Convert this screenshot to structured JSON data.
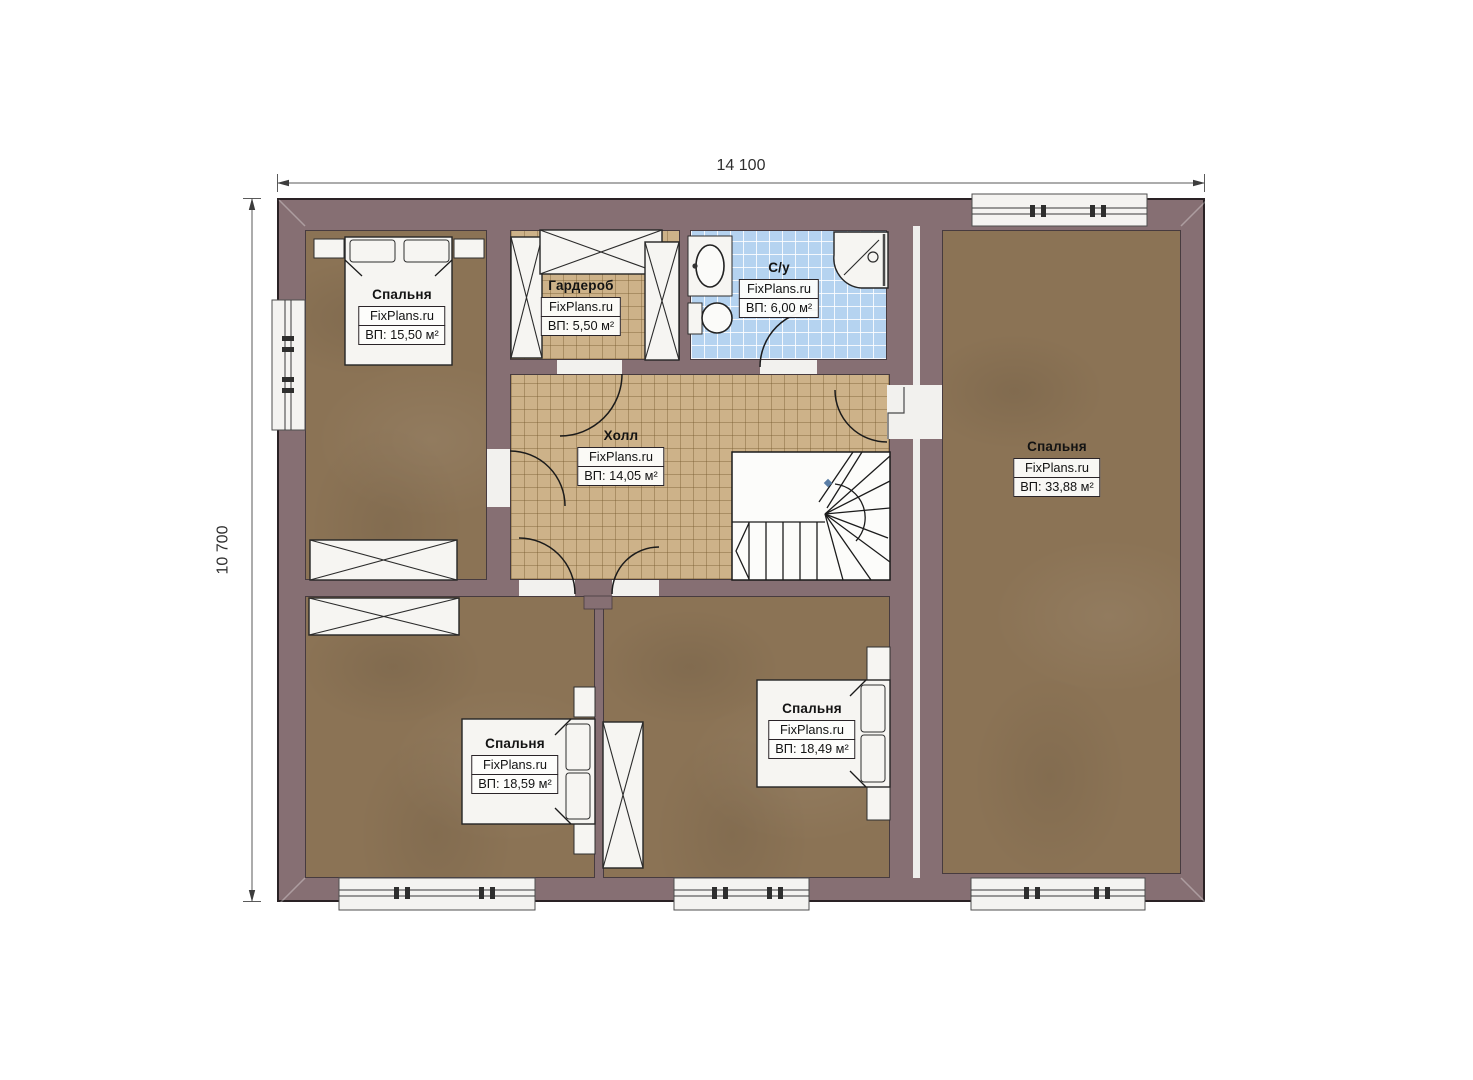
{
  "dimensions": {
    "width_label": "14 100",
    "height_label": "10 700"
  },
  "rooms": [
    {
      "id": "bedroom-top-left",
      "name": "Спальня",
      "brand": "FixPlans.ru",
      "area": "ВП: 15,50 м²"
    },
    {
      "id": "wardrobe",
      "name": "Гардероб",
      "brand": "FixPlans.ru",
      "area": "ВП: 5,50 м²"
    },
    {
      "id": "bathroom",
      "name": "С/у",
      "brand": "FixPlans.ru",
      "area": "ВП: 6,00 м²"
    },
    {
      "id": "hall",
      "name": "Холл",
      "brand": "FixPlans.ru",
      "area": "ВП: 14,05 м²"
    },
    {
      "id": "bedroom-right",
      "name": "Спальня",
      "brand": "FixPlans.ru",
      "area": "ВП: 33,88 м²"
    },
    {
      "id": "bedroom-bottom-left",
      "name": "Спальня",
      "brand": "FixPlans.ru",
      "area": "ВП: 18,59 м²"
    },
    {
      "id": "bedroom-bottom-middle",
      "name": "Спальня",
      "brand": "FixPlans.ru",
      "area": "ВП: 18,49 м²"
    }
  ],
  "colors": {
    "wall": "#866f73",
    "wall-line": "#2a2225",
    "floor-brown": "#8b7355",
    "tile-tan": "#cdb289",
    "bath-blue": "#b5d3f0",
    "furn-white": "#f6f5f2",
    "ink": "#1c1c1c"
  }
}
